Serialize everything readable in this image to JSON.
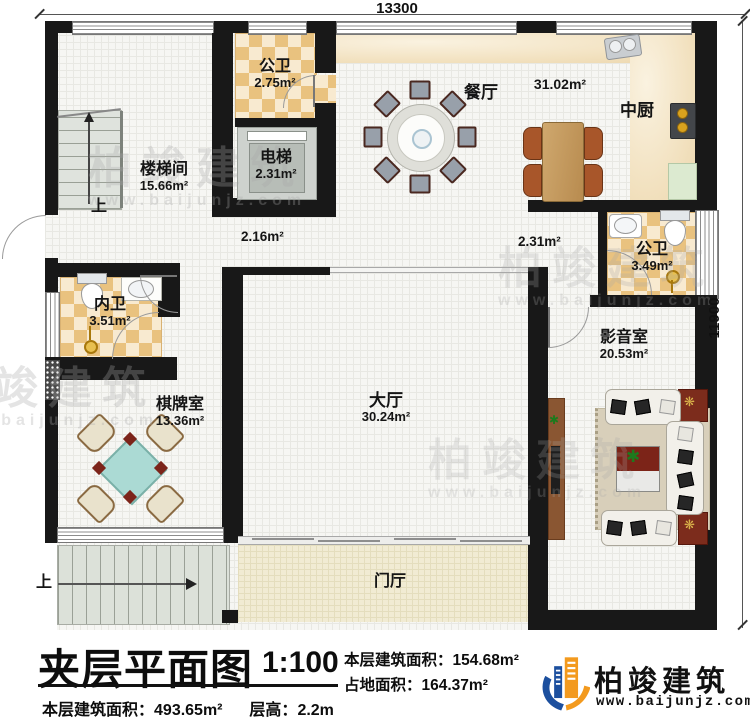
{
  "page": {
    "dimensions": {
      "top": "13300",
      "right": "11900"
    },
    "rooms": [
      {
        "name": "公卫",
        "area": "2.75m²"
      },
      {
        "name": "电梯",
        "area": "2.31m²"
      },
      {
        "name": "楼梯间",
        "area": "15.66m²"
      },
      {
        "name": "餐厅",
        "area": "31.02m²"
      },
      {
        "name": "中厨",
        "area": ""
      },
      {
        "name": "公卫",
        "area": "3.49m²"
      },
      {
        "name": "内卫",
        "area": "3.51m²"
      },
      {
        "name": "影音室",
        "area": "20.53m²"
      },
      {
        "name": "棋牌室",
        "area": "13.36m²"
      },
      {
        "name": "大厅",
        "area": "30.24m²"
      },
      {
        "name": "门厅",
        "area": ""
      }
    ],
    "passage_areas": {
      "left": "2.16m²",
      "right": "2.31m²"
    },
    "stairs": {
      "up_top": "上",
      "up_bottom": "上"
    },
    "title_block": {
      "title": "夹层平面图",
      "scale": "1:100",
      "floor_area_label": "本层建筑面积：",
      "floor_area_value": "154.68m²",
      "land_area_label": "占地面积：",
      "land_area_value": "164.37m²",
      "total_area_label": "本层建筑面积：",
      "total_area_value": "493.65m²",
      "height_label": "层高：",
      "height_value": "2.2m"
    },
    "brand": {
      "name": "柏竣建筑",
      "url": "www.baijunjz.com",
      "blue": "#1c4f9e",
      "orange": "#f39a1e"
    },
    "watermark": {
      "text": "柏竣建筑",
      "url": "www.baijunjz.com"
    }
  }
}
